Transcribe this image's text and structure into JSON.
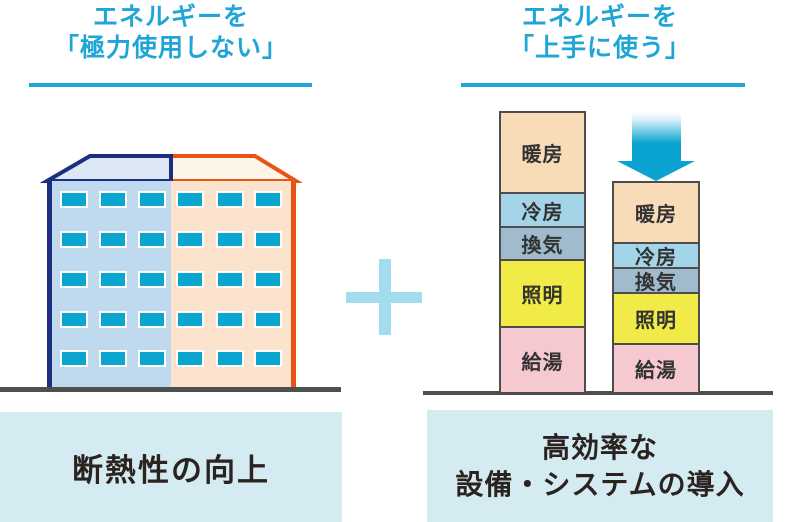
{
  "left_panel": {
    "title_line1": "エネルギーを",
    "title_line2": "「極力使用しない」",
    "caption": "断熱性の向上"
  },
  "right_panel": {
    "title_line1": "エネルギーを",
    "title_line2": "「上手に使う」",
    "caption_line1": "高効率な",
    "caption_line2": "設備・システムの導入"
  },
  "chart_data": {
    "type": "bar",
    "stacked": true,
    "legend_position": "none",
    "categories": [
      "before",
      "after"
    ],
    "bars": [
      {
        "name": "before",
        "segments": [
          {
            "label": "暖房",
            "relative_height": 79
          },
          {
            "label": "冷房",
            "relative_height": 34
          },
          {
            "label": "換気",
            "relative_height": 33
          },
          {
            "label": "照明",
            "relative_height": 67
          },
          {
            "label": "給湯",
            "relative_height": 66
          }
        ],
        "total_relative_height": 279
      },
      {
        "name": "after",
        "segments": [
          {
            "label": "暖房",
            "relative_height": 59
          },
          {
            "label": "冷房",
            "relative_height": 25
          },
          {
            "label": "換気",
            "relative_height": 25
          },
          {
            "label": "照明",
            "relative_height": 51
          },
          {
            "label": "給湯",
            "relative_height": 49
          }
        ],
        "total_relative_height": 209
      }
    ]
  },
  "icons": {
    "plus_icon": "plus-sign between the two concepts",
    "down_arrow_icon": "gradient arrow showing energy reduction"
  },
  "colors": {
    "title_cyan": "#1fa6d6",
    "caption_bg": "#d4ebf1",
    "caption_text": "#2b2320",
    "ground": "#4f4f4f",
    "plus": "#a2dcee",
    "bar_border": "#4d4d4d",
    "arrow_cyan": "#0ba3cf",
    "segments": {
      "heating": "#f8dcb8",
      "cooling": "#a4d4e8",
      "ventilation": "#9fbbcd",
      "lighting": "#f0eb46",
      "hot_water": "#f6c8cf"
    },
    "building": {
      "left_wall": "#bfd9ee",
      "right_wall": "#fbe3ce",
      "left_roof": "#dde8f6",
      "right_roof": "#fdf4e8",
      "left_outline_navy": "#1b2f80",
      "right_outline_orange": "#e85416",
      "window": "#0aa6d0"
    }
  }
}
